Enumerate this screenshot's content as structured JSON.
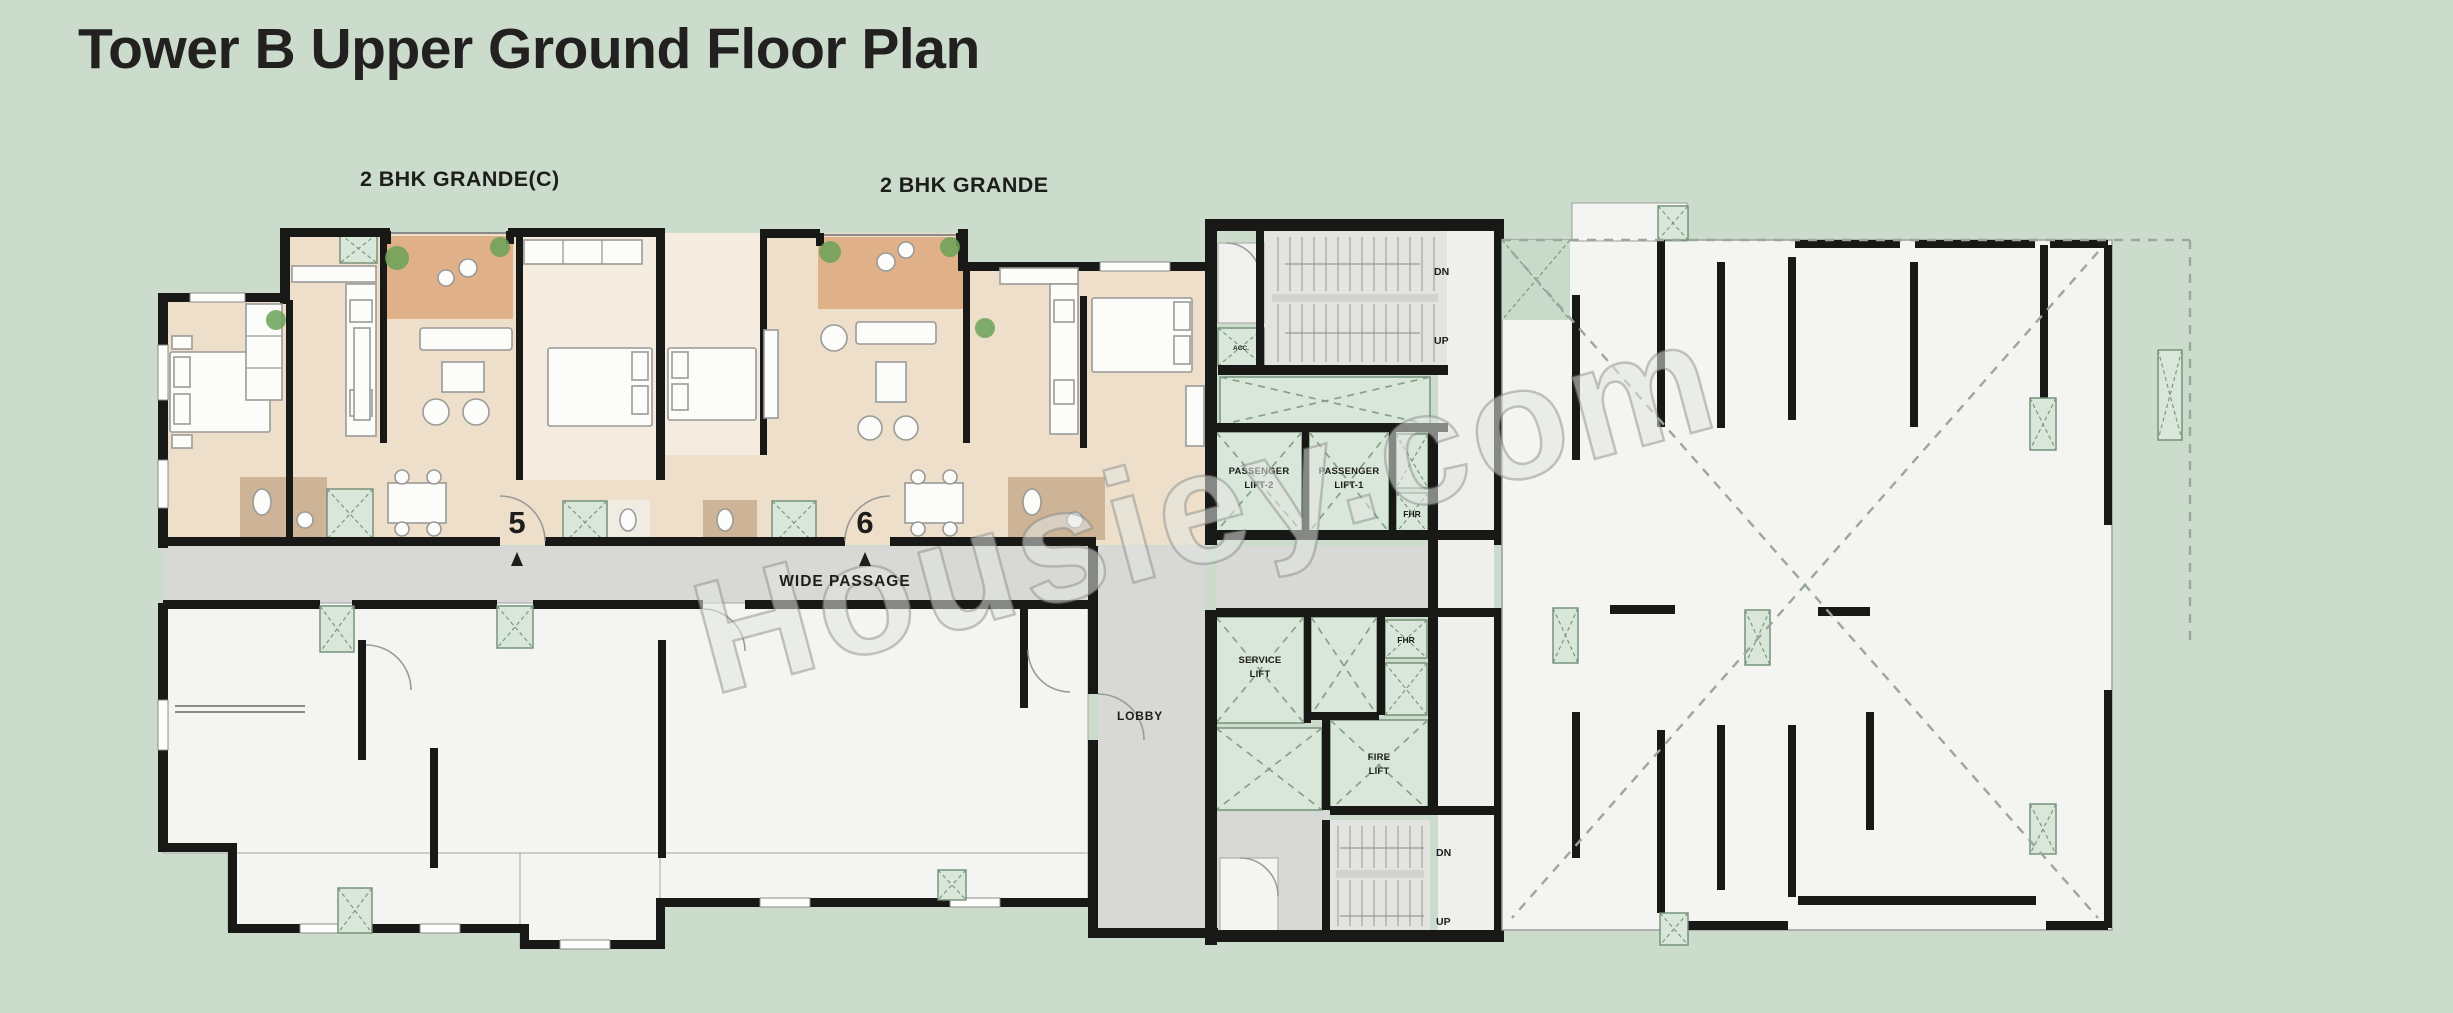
{
  "title": "Tower B Upper Ground Floor Plan",
  "watermark": "Housiey.com",
  "unit_labels": {
    "grande_c": "2 BHK GRANDE(C)",
    "grande": "2 BHK GRANDE"
  },
  "unit_numbers": {
    "unit5": "5",
    "unit6": "6"
  },
  "circulation": {
    "wide_passage": "WIDE PASSAGE",
    "lobby": "LOBBY"
  },
  "lifts": {
    "passenger2": {
      "l1": "PASSENGER",
      "l2": "LIFT-2"
    },
    "passenger1": {
      "l1": "PASSENGER",
      "l2": "LIFT-1"
    },
    "service": {
      "l1": "SERVICE",
      "l2": "LIFT"
    },
    "fire": {
      "l1": "FIRE",
      "l2": "LIFT"
    }
  },
  "shafts": {
    "fhr_upper": "FHR",
    "fhr_lower": "FHR",
    "acc": "ACC."
  },
  "stairs": {
    "top": {
      "dn": "DN",
      "up": "UP"
    },
    "bottom": {
      "dn": "DN",
      "up": "UP"
    }
  },
  "colors": {
    "background": "#cbdccd",
    "wall": "#181816",
    "unit_floor": "#eedfca",
    "deck_floor": "#e0b189",
    "bath_floor": "#cdb497",
    "shaft_green": "#d9e7da",
    "passage_gray": "#d8d8d6",
    "stair_gray": "#e3e3e1",
    "white_room": "#f4f4f2",
    "title_text": "#22211f",
    "watermark_gray": "#b7bcb7"
  }
}
